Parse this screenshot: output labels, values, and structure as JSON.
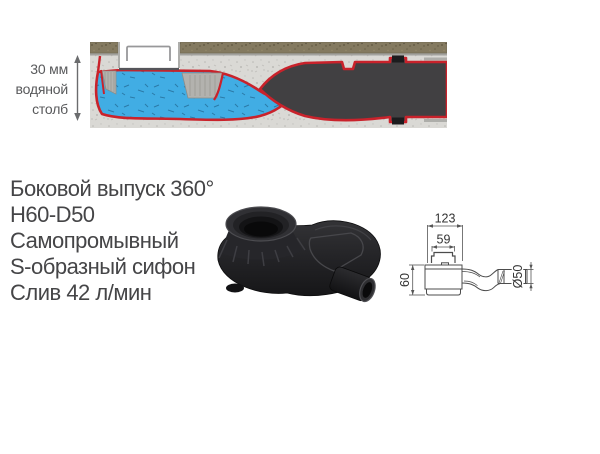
{
  "cross_section": {
    "water_column_label": {
      "lines": [
        "30 мм",
        "водяной",
        "столб"
      ]
    },
    "colors": {
      "water": "#41ade4",
      "membrane_red": "#c9222b",
      "siphon_body": "#414042",
      "concrete": "#dad9d5",
      "tile": "#847a60"
    }
  },
  "features": {
    "lines": [
      "Боковой выпуск 360°",
      "H60-D50",
      "Самопромывный",
      "S-образный сифон",
      "Слив 42 л/мин"
    ]
  },
  "product": {
    "color": "#232325"
  },
  "drawing": {
    "width_total": "123",
    "width_inner": "59",
    "height": "60",
    "diameter": "Ø50"
  }
}
